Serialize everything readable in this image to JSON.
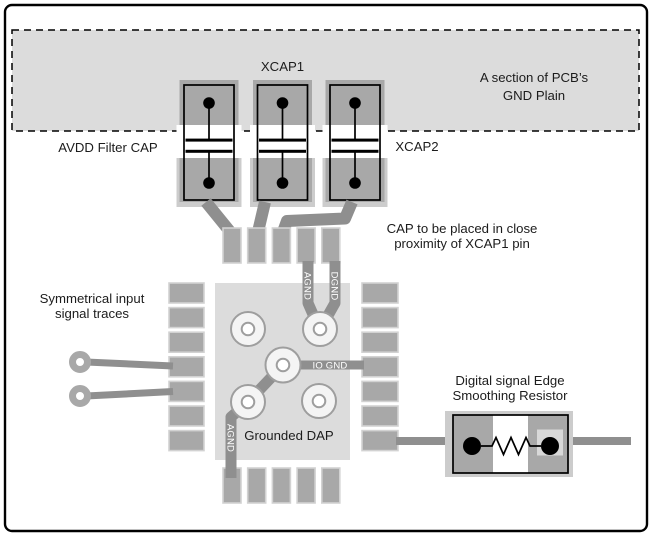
{
  "figure": {
    "gnd_plane": {
      "label_line1": "A section of PCB’s",
      "label_line2": "GND Plain"
    },
    "caps": {
      "xcap1_label": "XCAP1",
      "xcap2_label": "XCAP2",
      "avdd_label": "AVDD Filter CAP",
      "note_line1": "CAP to be placed in close",
      "note_line2": "proximity of XCAP1 pin"
    },
    "inputs": {
      "label_line1": "Symmetrical input",
      "label_line2": "signal traces"
    },
    "ic": {
      "dap_label": "Grounded DAP",
      "trace_labels": {
        "agnd_top": "AGND",
        "dgnd": "DGND",
        "io_gnd": "IO GND",
        "agnd_bottom": "AGND"
      }
    },
    "resistor": {
      "label_line1": "Digital signal Edge",
      "label_line2": "Smoothing Resistor"
    },
    "colors": {
      "plane": "#dcdcdc",
      "dap": "#dcdcdc",
      "pad": "#a8a8a8",
      "pad_border": "#d2d2d2",
      "pad_margin": "#cccccc",
      "trace": "#8f8f8f",
      "via_fill": "#f4f4f4",
      "via_stroke": "#9e9e9e",
      "outline": "#000000",
      "label_text": "#1c1c1c",
      "trace_label_text": "#ffffff"
    }
  }
}
